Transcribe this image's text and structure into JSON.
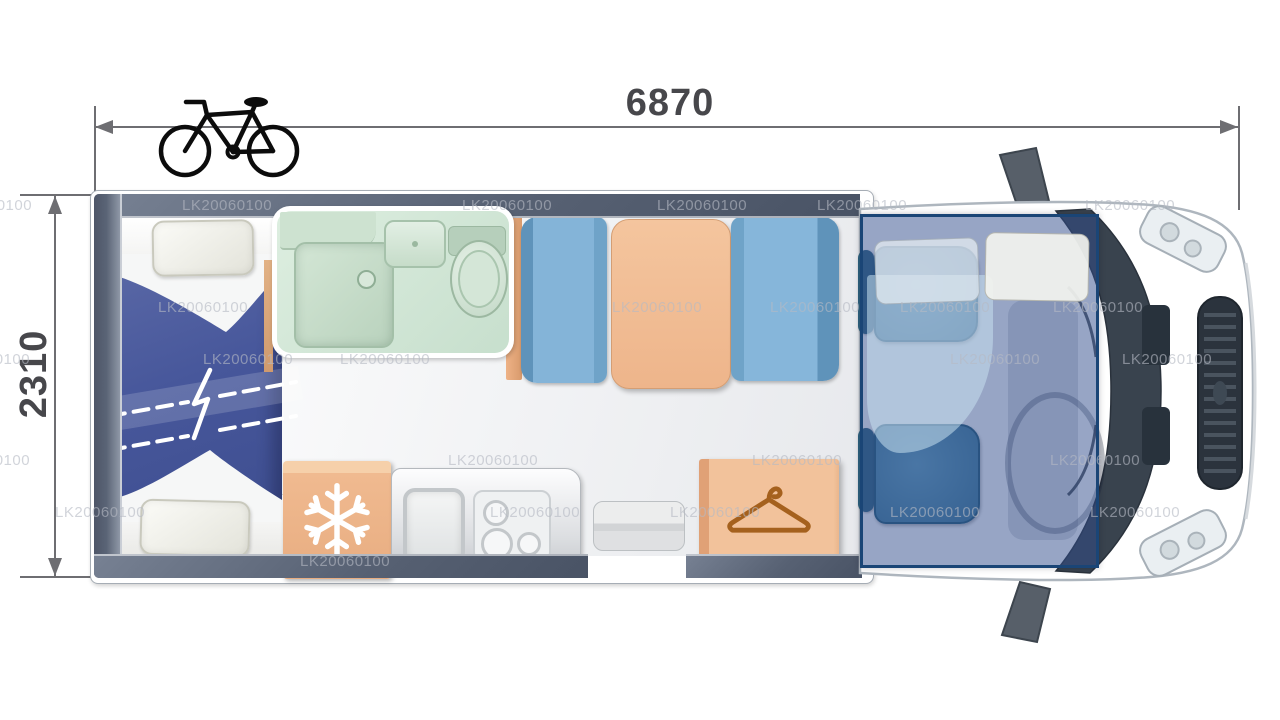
{
  "diagram": {
    "type": "motorhome-floorplan-top-view",
    "length_label": "6870",
    "width_label": "2310",
    "watermark": {
      "text": "LK20060100",
      "instances": [
        [
          -58,
          197
        ],
        [
          182,
          197
        ],
        [
          462,
          197
        ],
        [
          657,
          197
        ],
        [
          817,
          197
        ],
        [
          1085,
          197
        ],
        [
          158,
          299
        ],
        [
          612,
          299
        ],
        [
          770,
          299
        ],
        [
          900,
          299
        ],
        [
          1053,
          299
        ],
        [
          -60,
          351
        ],
        [
          203,
          351
        ],
        [
          340,
          351
        ],
        [
          950,
          351
        ],
        [
          1122,
          351
        ],
        [
          -60,
          452
        ],
        [
          448,
          452
        ],
        [
          752,
          452
        ],
        [
          1050,
          452
        ],
        [
          55,
          504
        ],
        [
          490,
          504
        ],
        [
          670,
          504
        ],
        [
          890,
          504
        ],
        [
          1090,
          504
        ],
        [
          300,
          553
        ]
      ]
    },
    "icons": {
      "bicycle": "bicycle-icon",
      "snowflake": "snowflake-icon (fridge)",
      "hanger": "hanger-icon (wardrobe)"
    },
    "colors": {
      "wall": "#576173",
      "floor": "#eceef0",
      "bathroom": "#d2e5d6",
      "seat_blue": "#84b4d8",
      "furniture_orange": "#f0bc94",
      "bed_duvet": "#47579b",
      "cab_seat": "#4a86a6",
      "dropdown_bed_overlay": "#2f4c8c",
      "dropdown_bed_border": "#1a4576",
      "dimension_text": "#47474b",
      "watermark": "#b6bac4"
    }
  }
}
